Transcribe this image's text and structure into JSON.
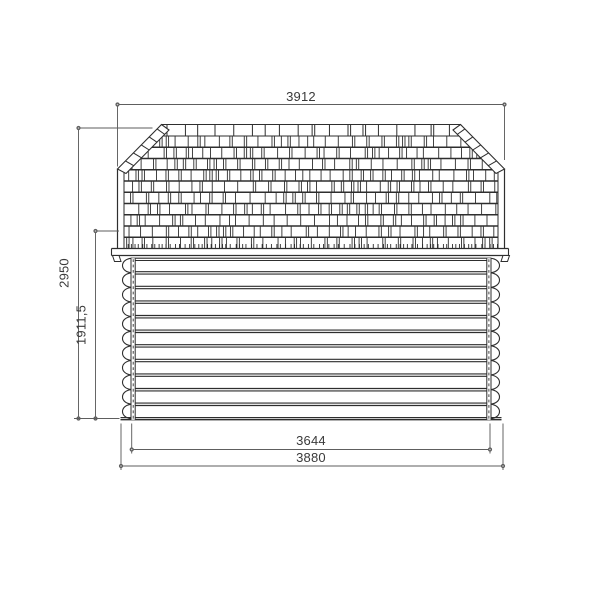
{
  "drawing": {
    "type": "technical-elevation",
    "subject": "log cabin rear elevation with gambrel shingle roof",
    "units_note": "",
    "dimensions": {
      "roof_width": "3912",
      "overall_height": "2950",
      "wall_height": "1911,5",
      "inner_width": "3644",
      "outer_width": "3880"
    }
  },
  "colors": {
    "line": "#2e2e2e",
    "dimension": "#5e5e5e",
    "text": "#3a3a3a",
    "background": "#ffffff"
  }
}
